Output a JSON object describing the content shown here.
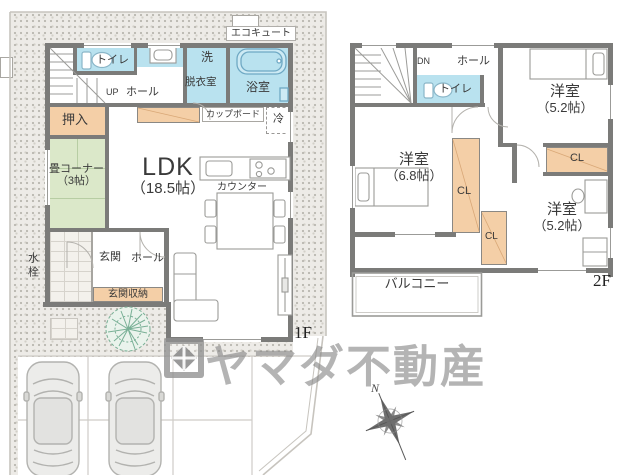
{
  "floor1": {
    "floor_label": "1F",
    "ecocute": "エコキュート",
    "toilet": "トイレ",
    "up": "UP",
    "hall_upper": "ホール",
    "wash_line1": "洗",
    "wash_line2": "脱衣室",
    "bath": "浴室",
    "oshiire": "押入",
    "cupboard": "カップボード",
    "fridge": "冷",
    "tatami_line1": "畳コーナー",
    "tatami_line2": "（3帖）",
    "ldk_line1": "LDK",
    "ldk_line2": "（18.5帖）",
    "counter": "カウンター",
    "genkan": "玄関",
    "hall_lower": "ホール",
    "genkan_storage": "玄関収納",
    "water_tap": "水栓"
  },
  "floor2": {
    "floor_label": "2F",
    "dn": "DN",
    "hall": "ホール",
    "toilet": "トイレ",
    "room_ne_line1": "洋室",
    "room_ne_line2": "（5.2帖）",
    "cl_right": "CL",
    "room_w_line1": "洋室",
    "room_w_line2": "（6.8帖）",
    "cl_mid": "CL",
    "cl_small": "CL",
    "room_se_line1": "洋室",
    "room_se_line2": "（5.2帖）",
    "balcony": "バルコニー"
  },
  "watermark": {
    "brand": "ヤマダ不動産"
  },
  "compass": {
    "north": "N"
  },
  "colors": {
    "wall": "#7b7b79",
    "wet_room_blue": "#b9e2ef",
    "closet_peach": "#f4cfa7",
    "tatami_green": "#dbe8c9",
    "ground_stipple": "#edebe7",
    "watermark_gray": "#868686",
    "tree_green": "#79b096"
  }
}
